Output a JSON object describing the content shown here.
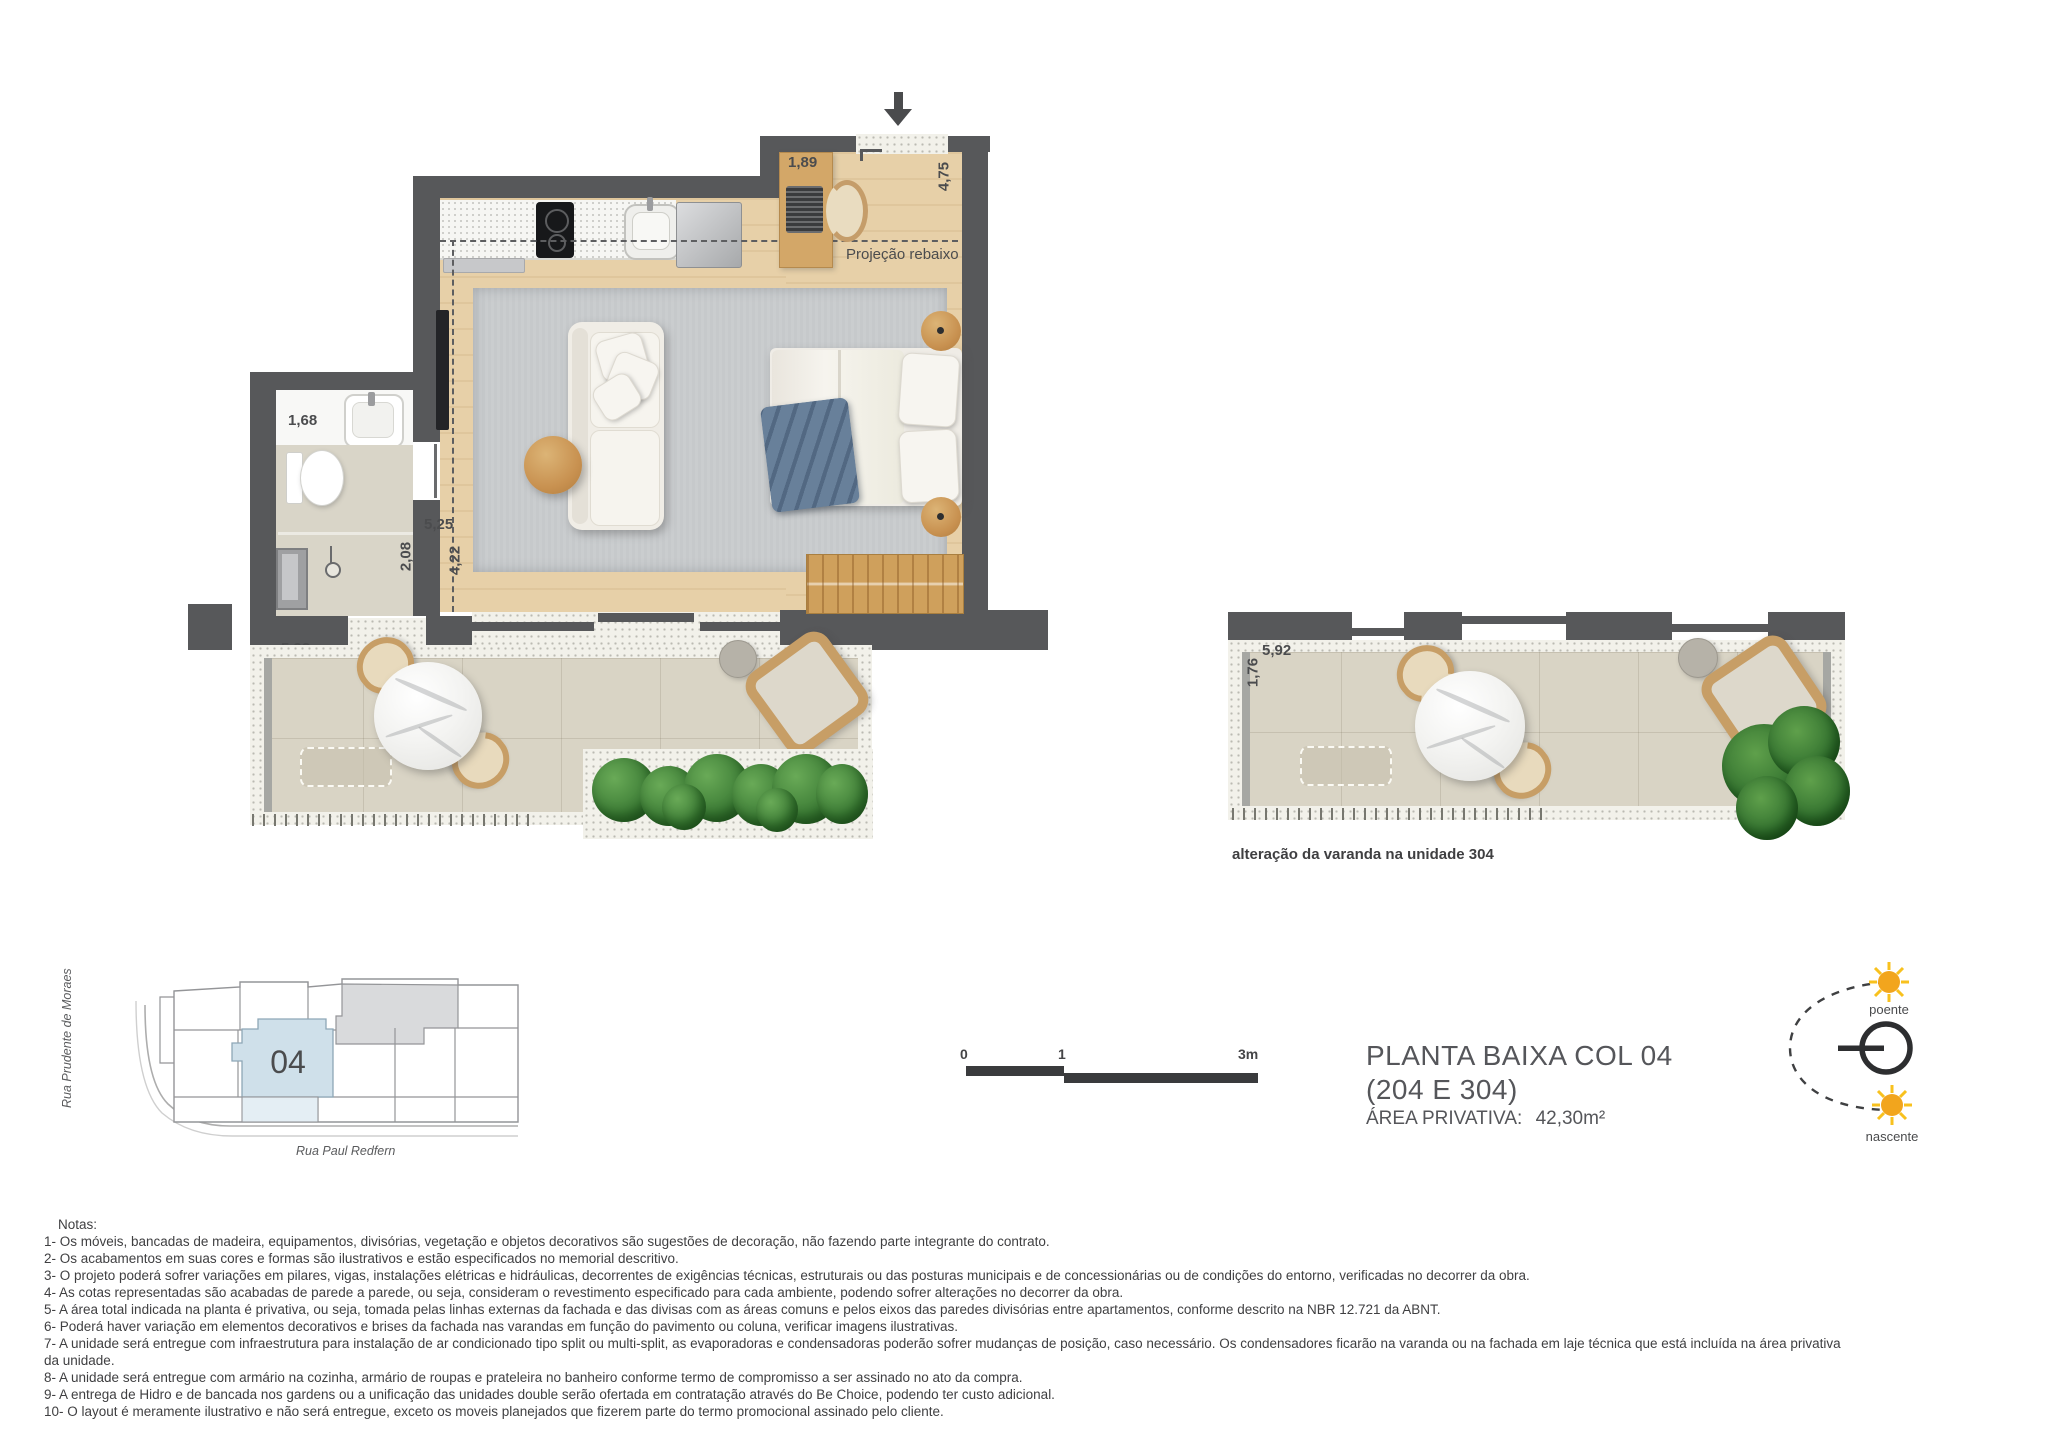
{
  "main_plan": {
    "dimensions": {
      "desk": "1,89",
      "entry_depth": "4,75",
      "bathroom_width": "1,68",
      "hall_depth": "2,08",
      "living_width": "5,25",
      "living_depth": "4,22",
      "balcony_width": "5,92",
      "planter_depth": "1,77"
    },
    "ceiling_label": "Projeção rebaixo"
  },
  "variation_plan": {
    "dimensions": {
      "balcony_width": "5,92",
      "balcony_depth": "1,76"
    },
    "caption": "alteração da varanda na unidade 304"
  },
  "key_map": {
    "unit_number": "04",
    "street_left": "Rua Prudente de Moraes",
    "street_bottom": "Rua Paul Redfern"
  },
  "scale_bar": {
    "tick_0": "0",
    "tick_1": "1",
    "tick_3": "3m"
  },
  "title_block": {
    "title_line1": "PLANTA BAIXA COL 04",
    "title_line2": "(204 E 304)",
    "area_label": "ÁREA PRIVATIVA:",
    "area_value": "42,30m²"
  },
  "compass": {
    "west_label": "poente",
    "east_label": "nascente"
  },
  "notes": {
    "heading": "Notas:",
    "items": [
      "1- Os móveis, bancadas de madeira, equipamentos, divisórias, vegetação e objetos decorativos são sugestões de decoração, não fazendo parte integrante do contrato.",
      "2- Os acabamentos em suas cores e formas são ilustrativos e estão especificados no memorial descritivo.",
      "3- O projeto poderá sofrer variações em pilares, vigas, instalações elétricas e hidráulicas, decorrentes de exigências técnicas, estruturais ou das posturas municipais e de concessionárias ou de condições do entorno, verificadas no decorrer da obra.",
      "4- As cotas representadas são acabadas de parede a parede, ou seja, consideram o revestimento especificado para cada ambiente, podendo sofrer alterações no decorrer da obra.",
      "5- A área total indicada na planta é privativa, ou seja, tomada pelas linhas externas da fachada e das divisas com as áreas comuns e pelos eixos das paredes divisórias entre apartamentos, conforme descrito na NBR 12.721 da ABNT.",
      "6- Poderá haver variação em elementos decorativos e brises da fachada nas varandas em função do pavimento ou coluna, verificar imagens ilustrativas.",
      "7- A unidade será entregue com infraestrutura para instalação de ar condicionado tipo split ou multi-split, as evaporadoras e condensadoras poderão sofrer mudanças de posição, caso necessário. Os condensadores ficarão na varanda ou na fachada em laje técnica que está incluída na área privativa da unidade.",
      "8- A unidade será entregue com armário na cozinha, armário de roupas e prateleira no banheiro conforme termo de compromisso a ser assinado no ato da compra.",
      "9- A entrega de Hidro e de bancada nos gardens ou a unificação das unidades double serão ofertada em contratação através do Be Choice, podendo ter custo adicional.",
      "10- O layout é meramente ilustrativo e não será entregue, exceto os moveis planejados que fizerem parte do termo promocional assinado pelo cliente."
    ]
  },
  "colors": {
    "wall": "#57585a",
    "wood_floor": "#e7d0a8",
    "rug": "#c6c9cb",
    "balcony_floor": "#d9d4c5",
    "highlight_unit": "#cfe0ea",
    "highlight_balcony": "#e4eef4",
    "gray_unit": "#d9dadc",
    "sun": "#f2a51d",
    "text": "#454547"
  }
}
